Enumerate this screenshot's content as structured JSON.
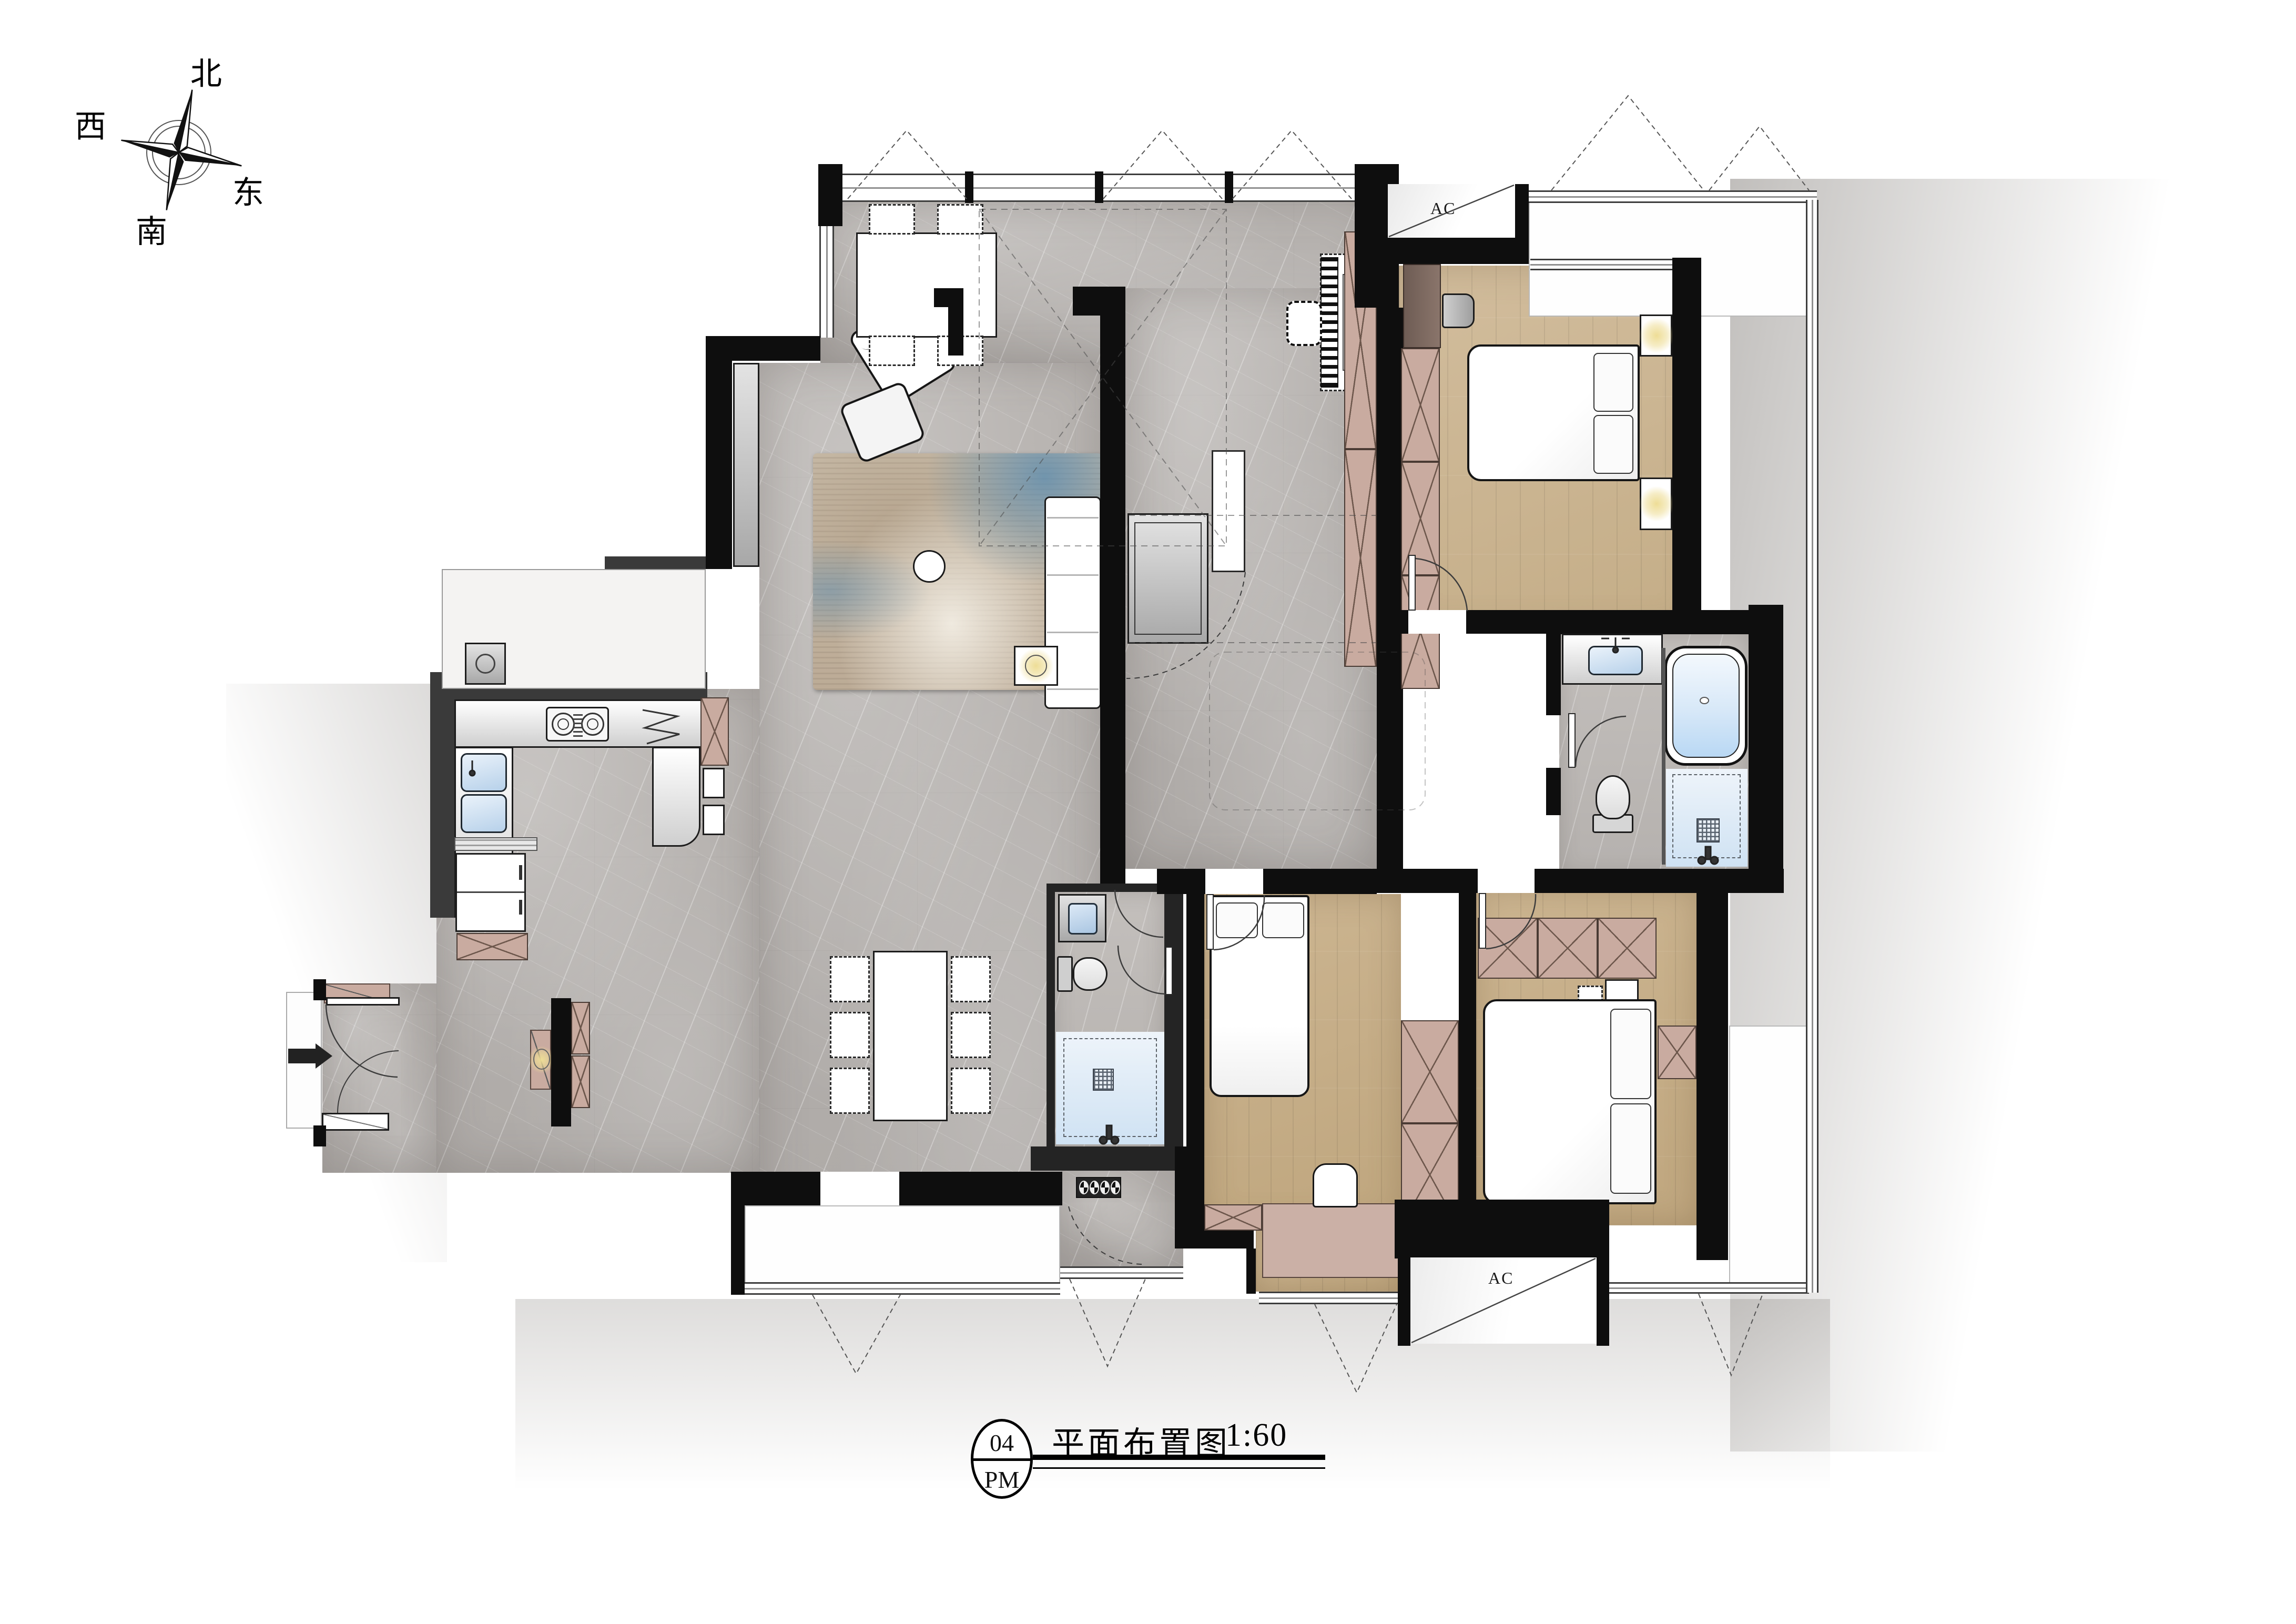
{
  "compass": {
    "north": "北",
    "south": "南",
    "east": "东",
    "west": "西"
  },
  "hvac": {
    "master_label": "AC",
    "south_label": "AC"
  },
  "title_block": {
    "number": "04",
    "code": "PM",
    "name": "平面布置图",
    "scale": "1:60"
  },
  "colors": {
    "wall": "#0e0e0e",
    "marble_floor": "#b7b3b0",
    "wood_floor": "#cdb897",
    "cabinet_pink": "#c9aba0",
    "water_blue": "#bcd8f0",
    "glow_yellow": "#eedd96",
    "counter_gray": "#e6e6e6"
  },
  "icons": {
    "compass-rose-icon": "four-point star",
    "stove-icon": "two burner rings with center grill",
    "sink-icon": "double basin with faucet",
    "bathtub-icon": "rounded tub with water",
    "shower-icon": "square drain grid",
    "toilet-icon": "bowl with tank",
    "washer-icon": "front-load drum",
    "piano-icon": "keyboard stripes",
    "ceiling-lamp-icon": "yellow glow with cross",
    "drying-rack-icon": "four pole circles",
    "door-swing-icon": "quarter arc",
    "entry-arrow-icon": "solid triangle arrow"
  }
}
